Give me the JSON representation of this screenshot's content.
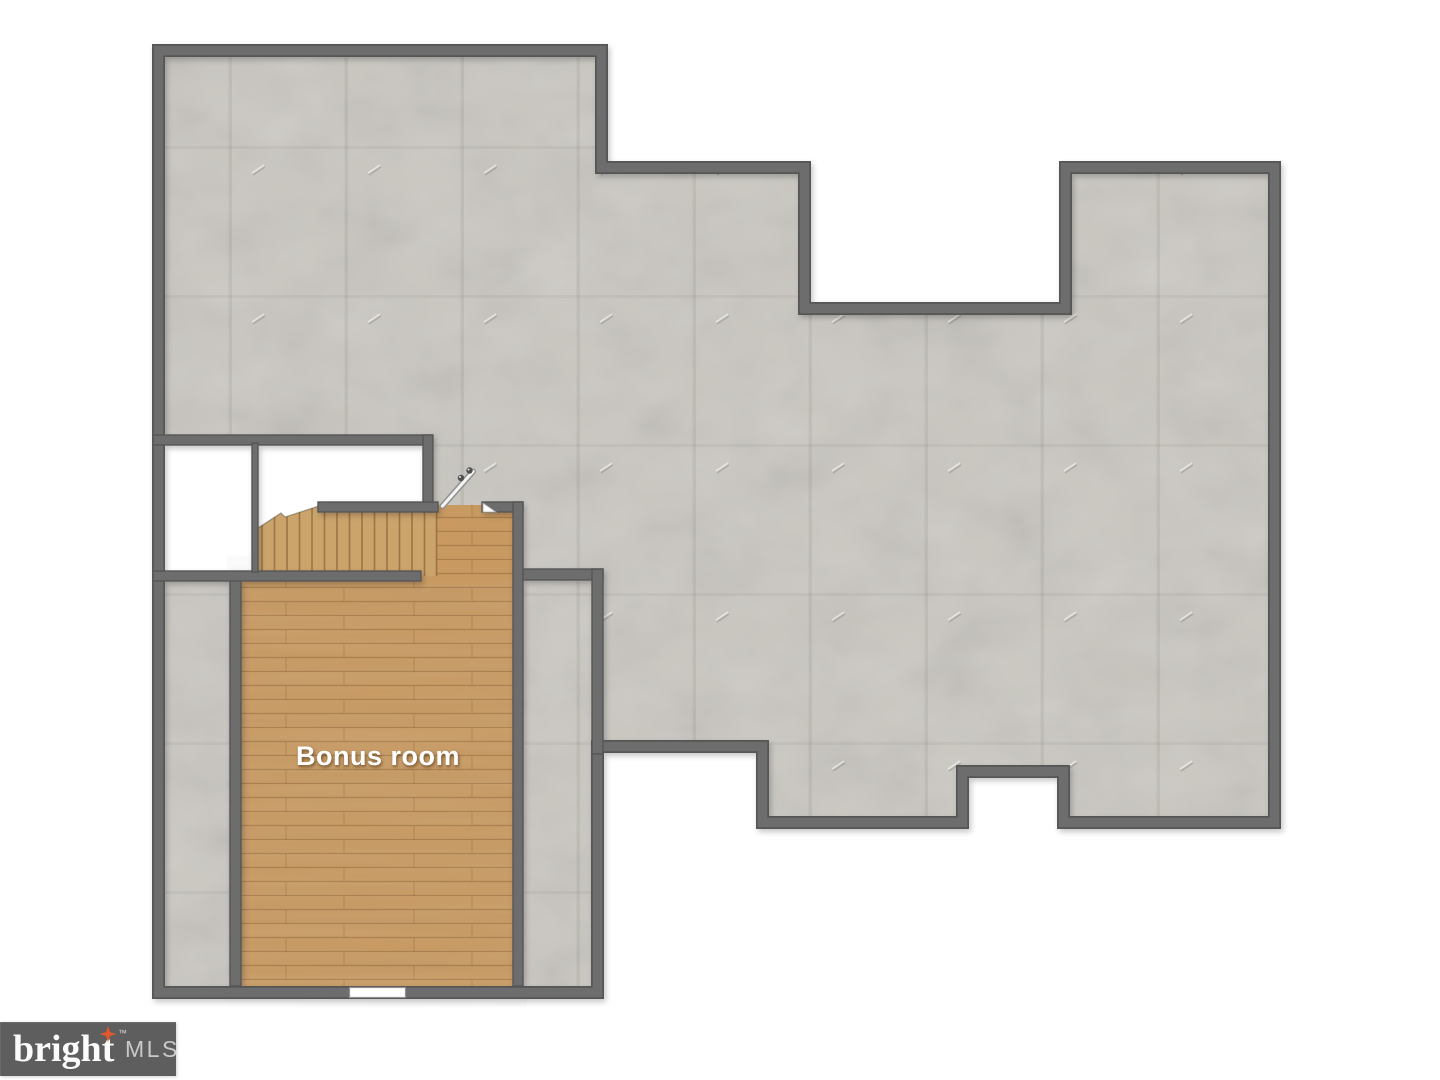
{
  "meta": {
    "kind": "real-estate floor plan",
    "floor": "attic / bonus level"
  },
  "labels": {
    "bonus_room": "Bonus room",
    "stairs_direction": "up"
  },
  "branding": {
    "word": "bright",
    "tm": "™",
    "suffix": "MLS"
  },
  "palette": {
    "wall": "#6d6d6d",
    "wall_edge": "#575757",
    "concrete": "#cac7c1",
    "wood": "#c89a62",
    "wood_line": "#7c5226",
    "outside": "#ffffff",
    "logo_bg": "#5e5e5e",
    "logo_text": "#fbfbfb",
    "logo_suffix": "#c9c9c9",
    "star": "#e0582b",
    "room_label_color": "#ffffff"
  }
}
